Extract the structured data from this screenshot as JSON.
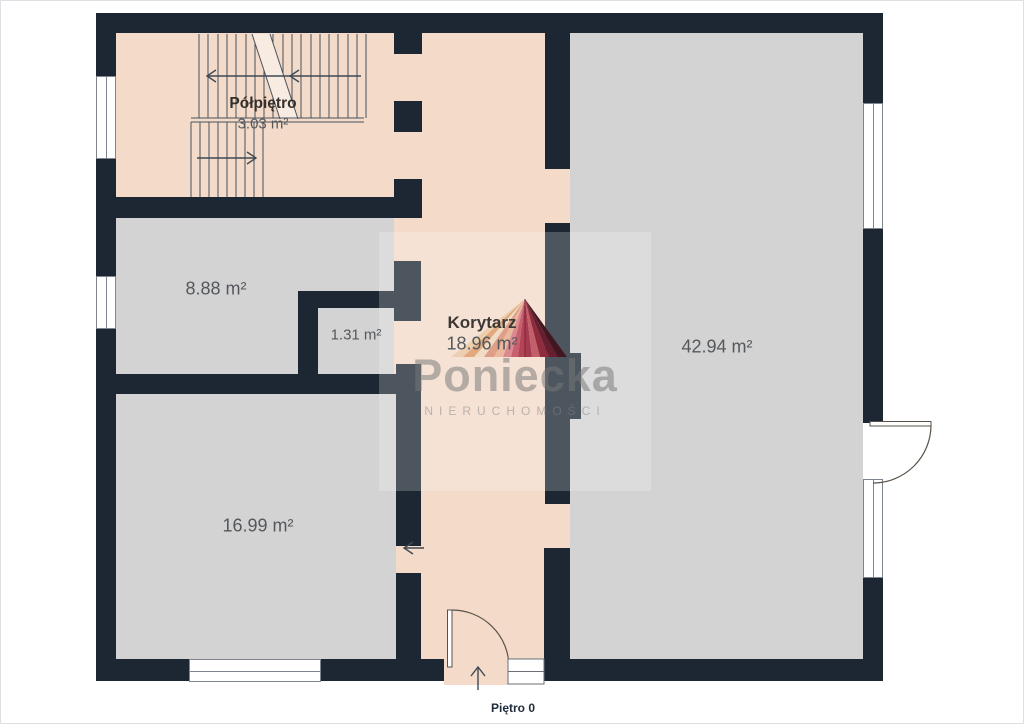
{
  "floor": {
    "label": "Piętro 0"
  },
  "rooms": {
    "polpietro": {
      "name": "Półpiętro",
      "area": "3.03 m²"
    },
    "r888": {
      "area": "8.88 m²"
    },
    "r131": {
      "area": "1.31 m²"
    },
    "korytarz": {
      "name": "Korytarz",
      "area": "18.96 m²"
    },
    "r4294": {
      "area": "42.94 m²"
    },
    "r1699": {
      "area": "16.99 m²"
    }
  },
  "watermark": {
    "brand": "Poniecka",
    "tagline": "NIERUCHOMOŚCI"
  },
  "colors": {
    "wall": "#1c2733",
    "floor_pink": "#f3dac9",
    "floor_gray": "#d3d3d3",
    "label_text": "#54585d",
    "room_name_text": "#3b3835",
    "logo_red": "#b54355"
  }
}
